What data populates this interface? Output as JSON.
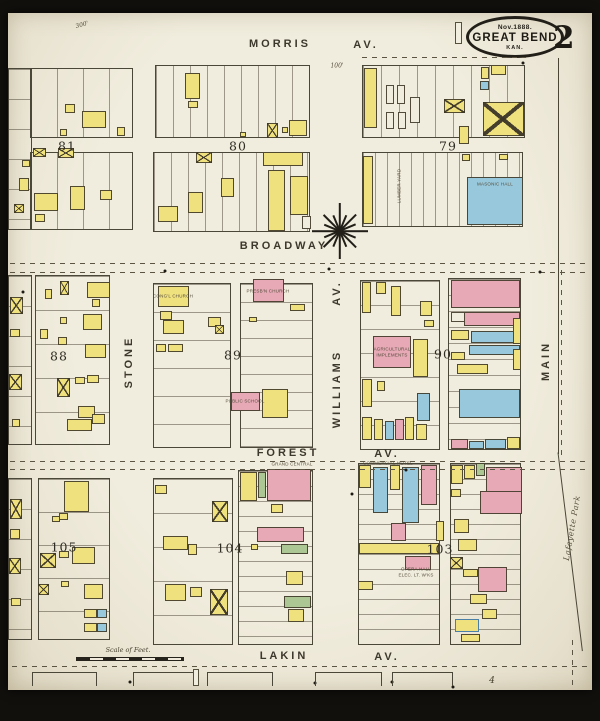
{
  "palette": {
    "paper": "#f1edde",
    "ink": "#3a362b",
    "yellow": "#f0e17f",
    "pink": "#e7a9b6",
    "blue": "#98c8db",
    "green": "#adc794",
    "backdrop": "#12100d"
  },
  "title_badge": {
    "date": "Nov.1888.",
    "city": "GREAT BEND",
    "state": "KAN."
  },
  "sheet_number": "2",
  "scale_bar_label": "Scale of Feet.",
  "labels": [
    {
      "t": "MORRIS",
      "x": 280,
      "y": 44,
      "c": "street"
    },
    {
      "t": "AV.",
      "x": 366,
      "y": 45,
      "c": "street"
    },
    {
      "t": "BROADWAY",
      "x": 284,
      "y": 246,
      "c": "street"
    },
    {
      "t": "FOREST",
      "x": 288,
      "y": 453,
      "c": "street"
    },
    {
      "t": "AV.",
      "x": 387,
      "y": 454,
      "c": "street"
    },
    {
      "t": "LAKIN",
      "x": 284,
      "y": 656,
      "c": "street"
    },
    {
      "t": "AV.",
      "x": 387,
      "y": 657,
      "c": "street"
    },
    {
      "t": "STONE",
      "x": 129,
      "y": 362,
      "c": "street",
      "r": -90
    },
    {
      "t": "WILLIAMS",
      "x": 337,
      "y": 389,
      "c": "street",
      "r": -90
    },
    {
      "t": "AV.",
      "x": 337,
      "y": 293,
      "c": "street",
      "r": -90
    },
    {
      "t": "MAIN",
      "x": 546,
      "y": 361,
      "c": "street",
      "r": -90
    },
    {
      "t": "Lafayette Park",
      "x": 572,
      "y": 528,
      "c": "script",
      "r": -80
    },
    {
      "t": "81",
      "x": 67,
      "y": 146,
      "c": "blocknum"
    },
    {
      "t": "80",
      "x": 238,
      "y": 146,
      "c": "blocknum"
    },
    {
      "t": "79",
      "x": 448,
      "y": 146,
      "c": "blocknum"
    },
    {
      "t": "88",
      "x": 59,
      "y": 356,
      "c": "blocknum"
    },
    {
      "t": "89",
      "x": 233,
      "y": 355,
      "c": "blocknum"
    },
    {
      "t": "90",
      "x": 443,
      "y": 354,
      "c": "blocknum"
    },
    {
      "t": "105",
      "x": 64,
      "y": 547,
      "c": "blocknum"
    },
    {
      "t": "104",
      "x": 230,
      "y": 548,
      "c": "blocknum"
    },
    {
      "t": "103",
      "x": 440,
      "y": 549,
      "c": "blocknum"
    },
    {
      "t": "CONG'L CHURCH",
      "x": 173,
      "y": 296,
      "c": "tiny"
    },
    {
      "t": "PRESB'N CHURCH",
      "x": 268,
      "y": 291,
      "c": "tiny"
    },
    {
      "t": "PUBLIC SCHOOL",
      "x": 245,
      "y": 401,
      "c": "tiny"
    },
    {
      "t": "MASONIC HALL",
      "x": 495,
      "y": 184,
      "c": "tiny"
    },
    {
      "t": "LUMBER YARD",
      "x": 399,
      "y": 186,
      "c": "tiny",
      "r": -90
    },
    {
      "t": "AGRICULTURAL",
      "x": 392,
      "y": 349,
      "c": "tiny"
    },
    {
      "t": "IMPLEMENTS",
      "x": 392,
      "y": 355,
      "c": "tiny"
    },
    {
      "t": "OPERA HALL",
      "x": 416,
      "y": 569,
      "c": "tiny"
    },
    {
      "t": "ELEC. LT. W'KS",
      "x": 416,
      "y": 575,
      "c": "tiny"
    },
    {
      "t": "GRAND CENTRAL",
      "x": 292,
      "y": 464,
      "c": "tiny"
    },
    {
      "t": "COMMERCIAL HOTEL",
      "x": 388,
      "y": 463,
      "c": "tiny"
    },
    {
      "t": "100'",
      "x": 337,
      "y": 66,
      "c": "ital"
    },
    {
      "t": "300'",
      "x": 82,
      "y": 25,
      "c": "ital",
      "r": -15
    },
    {
      "t": "Scale of Feet.",
      "x": 128,
      "y": 650,
      "c": "scale"
    },
    {
      "t": "4",
      "x": 492,
      "y": 681,
      "c": "adj"
    }
  ],
  "buildings": [
    [
      65,
      104,
      10,
      9,
      "Y"
    ],
    [
      82,
      111,
      24,
      17,
      "Y"
    ],
    [
      117,
      127,
      8,
      9,
      "Y"
    ],
    [
      60,
      129,
      7,
      7,
      "Y"
    ],
    [
      33,
      148,
      13,
      9,
      "Y",
      "x"
    ],
    [
      58,
      148,
      16,
      10,
      "Y",
      "x"
    ],
    [
      34,
      193,
      24,
      18,
      "Y"
    ],
    [
      70,
      186,
      15,
      24,
      "Y"
    ],
    [
      35,
      214,
      10,
      8,
      "Y"
    ],
    [
      100,
      190,
      12,
      10,
      "Y"
    ],
    [
      22,
      160,
      8,
      7,
      "Y"
    ],
    [
      19,
      178,
      10,
      13,
      "Y"
    ],
    [
      14,
      204,
      10,
      9,
      "Y",
      "x"
    ],
    [
      185,
      73,
      15,
      26,
      "Y"
    ],
    [
      188,
      101,
      10,
      7,
      "Y"
    ],
    [
      267,
      123,
      11,
      15,
      "Y",
      "x"
    ],
    [
      282,
      127,
      6,
      6,
      "Y"
    ],
    [
      289,
      120,
      18,
      16,
      "Y"
    ],
    [
      240,
      132,
      6,
      5,
      "Y"
    ],
    [
      196,
      152,
      16,
      11,
      "Y",
      "x"
    ],
    [
      158,
      206,
      20,
      16,
      "Y"
    ],
    [
      188,
      192,
      15,
      21,
      "Y"
    ],
    [
      221,
      178,
      13,
      19,
      "Y"
    ],
    [
      263,
      152,
      40,
      14,
      "Y"
    ],
    [
      268,
      170,
      17,
      61,
      "Y"
    ],
    [
      290,
      176,
      18,
      39,
      "Y"
    ],
    [
      302,
      216,
      9,
      13,
      "W"
    ],
    [
      364,
      68,
      13,
      60,
      "Y"
    ],
    [
      386,
      85,
      8,
      19,
      "W"
    ],
    [
      397,
      85,
      8,
      19,
      "W"
    ],
    [
      386,
      112,
      8,
      17,
      "W"
    ],
    [
      398,
      112,
      8,
      17,
      "W"
    ],
    [
      410,
      97,
      10,
      26,
      "W"
    ],
    [
      444,
      99,
      21,
      14,
      "Y",
      "x"
    ],
    [
      459,
      126,
      10,
      18,
      "Y"
    ],
    [
      481,
      67,
      8,
      12,
      "Y"
    ],
    [
      491,
      65,
      15,
      10,
      "Y"
    ],
    [
      480,
      81,
      9,
      9,
      "B"
    ],
    [
      483,
      102,
      41,
      34,
      "Y",
      "x"
    ],
    [
      363,
      156,
      10,
      68,
      "Y"
    ],
    [
      462,
      154,
      8,
      7,
      "Y"
    ],
    [
      499,
      154,
      9,
      6,
      "Y"
    ],
    [
      467,
      177,
      56,
      48,
      "B"
    ],
    [
      60,
      281,
      9,
      14,
      "Y",
      "x"
    ],
    [
      45,
      289,
      7,
      10,
      "Y"
    ],
    [
      87,
      282,
      23,
      16,
      "Y"
    ],
    [
      92,
      299,
      8,
      8,
      "Y"
    ],
    [
      60,
      317,
      7,
      7,
      "Y"
    ],
    [
      83,
      314,
      19,
      16,
      "Y"
    ],
    [
      40,
      329,
      8,
      10,
      "Y"
    ],
    [
      58,
      337,
      9,
      8,
      "Y"
    ],
    [
      85,
      344,
      21,
      14,
      "Y"
    ],
    [
      57,
      378,
      13,
      19,
      "Y",
      "x"
    ],
    [
      75,
      377,
      10,
      7,
      "Y"
    ],
    [
      87,
      375,
      12,
      8,
      "Y"
    ],
    [
      78,
      406,
      17,
      12,
      "Y"
    ],
    [
      67,
      419,
      25,
      12,
      "Y"
    ],
    [
      92,
      414,
      13,
      10,
      "Y"
    ],
    [
      10,
      297,
      13,
      17,
      "Y",
      "x"
    ],
    [
      10,
      329,
      10,
      8,
      "Y"
    ],
    [
      9,
      374,
      13,
      16,
      "Y",
      "x"
    ],
    [
      12,
      419,
      8,
      8,
      "Y"
    ],
    [
      158,
      286,
      31,
      21,
      "Y"
    ],
    [
      160,
      311,
      12,
      9,
      "Y"
    ],
    [
      163,
      320,
      21,
      14,
      "Y"
    ],
    [
      208,
      317,
      13,
      10,
      "Y"
    ],
    [
      215,
      325,
      9,
      9,
      "Y",
      "x"
    ],
    [
      156,
      344,
      10,
      8,
      "Y"
    ],
    [
      168,
      344,
      15,
      8,
      "Y"
    ],
    [
      253,
      279,
      31,
      23,
      "P"
    ],
    [
      290,
      304,
      15,
      7,
      "Y"
    ],
    [
      249,
      317,
      8,
      5,
      "Y"
    ],
    [
      231,
      392,
      29,
      19,
      "P"
    ],
    [
      262,
      389,
      26,
      29,
      "Y"
    ],
    [
      362,
      282,
      9,
      31,
      "Y"
    ],
    [
      376,
      282,
      10,
      12,
      "Y"
    ],
    [
      391,
      286,
      10,
      30,
      "Y"
    ],
    [
      420,
      301,
      12,
      15,
      "Y"
    ],
    [
      424,
      320,
      10,
      7,
      "Y"
    ],
    [
      373,
      336,
      38,
      32,
      "P"
    ],
    [
      413,
      339,
      15,
      38,
      "Y"
    ],
    [
      362,
      379,
      10,
      28,
      "Y"
    ],
    [
      377,
      381,
      8,
      10,
      "Y"
    ],
    [
      417,
      393,
      13,
      28,
      "B"
    ],
    [
      362,
      417,
      10,
      23,
      "Y"
    ],
    [
      374,
      419,
      9,
      21,
      "Y"
    ],
    [
      385,
      421,
      9,
      19,
      "B"
    ],
    [
      395,
      419,
      9,
      21,
      "P"
    ],
    [
      405,
      417,
      9,
      23,
      "Y"
    ],
    [
      416,
      424,
      11,
      16,
      "Y"
    ],
    [
      451,
      280,
      69,
      28,
      "P"
    ],
    [
      451,
      312,
      20,
      10,
      "W"
    ],
    [
      464,
      312,
      56,
      14,
      "P"
    ],
    [
      451,
      330,
      18,
      10,
      "Y"
    ],
    [
      471,
      331,
      49,
      12,
      "B"
    ],
    [
      469,
      345,
      51,
      10,
      "B"
    ],
    [
      451,
      352,
      14,
      8,
      "Y"
    ],
    [
      457,
      364,
      31,
      10,
      "Y"
    ],
    [
      459,
      389,
      61,
      29,
      "B"
    ],
    [
      451,
      439,
      17,
      10,
      "P"
    ],
    [
      469,
      441,
      15,
      8,
      "B"
    ],
    [
      485,
      439,
      21,
      10,
      "B"
    ],
    [
      507,
      437,
      13,
      12,
      "Y"
    ],
    [
      513,
      318,
      8,
      26,
      "Y"
    ],
    [
      513,
      349,
      8,
      21,
      "Y"
    ],
    [
      64,
      481,
      25,
      31,
      "Y"
    ],
    [
      59,
      513,
      9,
      7,
      "Y"
    ],
    [
      52,
      516,
      8,
      6,
      "Y"
    ],
    [
      40,
      553,
      16,
      15,
      "Y",
      "x"
    ],
    [
      59,
      551,
      10,
      7,
      "Y"
    ],
    [
      72,
      547,
      23,
      17,
      "Y"
    ],
    [
      84,
      584,
      19,
      15,
      "Y"
    ],
    [
      38,
      584,
      11,
      11,
      "Y",
      "x"
    ],
    [
      61,
      581,
      8,
      6,
      "Y"
    ],
    [
      84,
      609,
      13,
      9,
      "Y"
    ],
    [
      97,
      609,
      10,
      9,
      "B"
    ],
    [
      84,
      623,
      13,
      9,
      "Y"
    ],
    [
      97,
      623,
      10,
      9,
      "B"
    ],
    [
      10,
      499,
      12,
      20,
      "Y",
      "x"
    ],
    [
      10,
      529,
      10,
      10,
      "Y"
    ],
    [
      9,
      558,
      12,
      16,
      "Y",
      "x"
    ],
    [
      11,
      598,
      10,
      8,
      "Y"
    ],
    [
      212,
      501,
      16,
      21,
      "Y",
      "x"
    ],
    [
      163,
      536,
      25,
      14,
      "Y"
    ],
    [
      188,
      544,
      9,
      11,
      "Y"
    ],
    [
      165,
      584,
      21,
      17,
      "Y"
    ],
    [
      190,
      587,
      12,
      10,
      "Y"
    ],
    [
      210,
      589,
      18,
      26,
      "Y",
      "x"
    ],
    [
      155,
      485,
      12,
      9,
      "Y"
    ],
    [
      240,
      472,
      17,
      29,
      "Y"
    ],
    [
      258,
      472,
      8,
      26,
      "G"
    ],
    [
      267,
      469,
      44,
      32,
      "P"
    ],
    [
      271,
      504,
      12,
      9,
      "Y"
    ],
    [
      257,
      527,
      47,
      15,
      "P"
    ],
    [
      251,
      544,
      7,
      6,
      "Y"
    ],
    [
      281,
      544,
      27,
      10,
      "G"
    ],
    [
      286,
      571,
      17,
      14,
      "Y"
    ],
    [
      284,
      596,
      27,
      12,
      "G"
    ],
    [
      288,
      609,
      16,
      13,
      "Y"
    ],
    [
      359,
      465,
      12,
      23,
      "Y"
    ],
    [
      373,
      467,
      15,
      46,
      "B"
    ],
    [
      390,
      465,
      10,
      25,
      "Y"
    ],
    [
      402,
      467,
      17,
      56,
      "B"
    ],
    [
      421,
      465,
      16,
      40,
      "P"
    ],
    [
      391,
      523,
      15,
      18,
      "P"
    ],
    [
      359,
      543,
      80,
      11,
      "Y"
    ],
    [
      405,
      556,
      26,
      14,
      "P"
    ],
    [
      358,
      581,
      15,
      9,
      "Y"
    ],
    [
      436,
      521,
      8,
      20,
      "Y"
    ],
    [
      451,
      465,
      12,
      19,
      "Y"
    ],
    [
      464,
      465,
      11,
      14,
      "Y"
    ],
    [
      476,
      463,
      9,
      13,
      "G"
    ],
    [
      486,
      467,
      36,
      29,
      "P"
    ],
    [
      451,
      489,
      10,
      8,
      "Y"
    ],
    [
      480,
      491,
      42,
      23,
      "P"
    ],
    [
      454,
      519,
      15,
      14,
      "Y"
    ],
    [
      458,
      539,
      19,
      12,
      "Y"
    ],
    [
      450,
      557,
      13,
      12,
      "Y",
      "x"
    ],
    [
      463,
      569,
      15,
      8,
      "Y"
    ],
    [
      478,
      567,
      29,
      25,
      "P"
    ],
    [
      470,
      594,
      17,
      10,
      "Y"
    ],
    [
      482,
      609,
      15,
      10,
      "Y"
    ],
    [
      455,
      619,
      24,
      13,
      "Y",
      "bb"
    ],
    [
      461,
      634,
      19,
      8,
      "Y"
    ]
  ],
  "geometry": {
    "lot_grids": [
      [
        30,
        68,
        103,
        70,
        "v",
        26
      ],
      [
        30,
        152,
        103,
        78,
        "v",
        26
      ],
      [
        155,
        65,
        155,
        73,
        "v",
        17
      ],
      [
        153,
        152,
        157,
        80,
        "v",
        17
      ],
      [
        362,
        65,
        163,
        73,
        "v",
        18
      ],
      [
        362,
        152,
        161,
        75,
        "v",
        12
      ],
      [
        35,
        275,
        75,
        170,
        "h",
        34
      ],
      [
        153,
        283,
        78,
        165,
        "h",
        28
      ],
      [
        240,
        283,
        73,
        165,
        "h",
        18
      ],
      [
        360,
        280,
        80,
        170,
        "h",
        24
      ],
      [
        448,
        278,
        73,
        172,
        "h",
        16
      ],
      [
        38,
        478,
        72,
        162,
        "h",
        33
      ],
      [
        153,
        478,
        80,
        167,
        "h",
        34
      ],
      [
        238,
        470,
        75,
        175,
        "h",
        15
      ],
      [
        358,
        463,
        82,
        182,
        "h",
        15
      ],
      [
        450,
        463,
        71,
        182,
        "h",
        15
      ],
      [
        8,
        275,
        24,
        170,
        "h",
        30
      ],
      [
        8,
        478,
        24,
        162,
        "h",
        30
      ],
      [
        8,
        68,
        24,
        162,
        "h",
        30
      ]
    ],
    "brackets": [
      [
        32,
        672,
        65,
        14
      ],
      [
        133,
        672,
        64,
        14
      ],
      [
        207,
        672,
        66,
        14
      ],
      [
        315,
        672,
        67,
        14
      ],
      [
        392,
        672,
        61,
        14
      ]
    ],
    "dashes_h": [
      [
        10,
        263,
        580
      ],
      [
        10,
        272,
        580
      ],
      [
        10,
        461,
        578
      ],
      [
        10,
        469,
        578
      ],
      [
        12,
        666,
        578
      ],
      [
        362,
        57,
        164
      ]
    ],
    "dashes_v": [
      [
        561,
        270,
        190
      ],
      [
        572,
        640,
        48
      ]
    ],
    "dots": [
      [
        523,
        63
      ],
      [
        540,
        272
      ],
      [
        165,
        271
      ],
      [
        23,
        292
      ],
      [
        406,
        470
      ],
      [
        352,
        494
      ],
      [
        329,
        269
      ],
      [
        130,
        682
      ],
      [
        315,
        683
      ],
      [
        392,
        682
      ],
      [
        453,
        687
      ]
    ],
    "vlines": [
      [
        558,
        58,
        396
      ]
    ],
    "park_line": {
      "x": 558,
      "y": 452,
      "len": 200,
      "rot": 83
    },
    "patches": [
      [
        455,
        22,
        7,
        22
      ],
      [
        193,
        669,
        6,
        17
      ]
    ]
  }
}
